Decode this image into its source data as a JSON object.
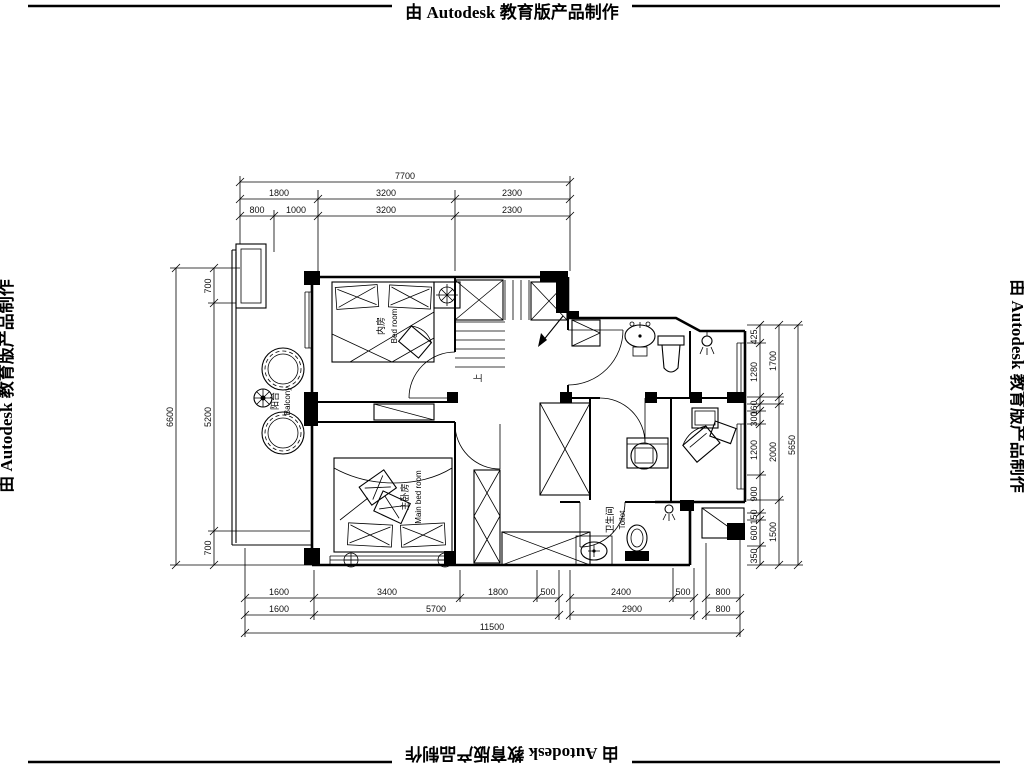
{
  "stamp": {
    "text": "由 Autodesk 教育版产品制作"
  },
  "rooms": {
    "bedroom": {
      "zh": "内房",
      "en": "Bed room"
    },
    "main_bedroom": {
      "zh": "主卧房",
      "en": "Main bed room"
    },
    "balcony": {
      "zh": "阳台",
      "en": "Balcony"
    },
    "toilet": {
      "zh": "卫生间",
      "en": "Toilet"
    },
    "stair_up": "上"
  },
  "dims": {
    "top": {
      "overall": "7700",
      "row2": [
        "1800",
        "3200",
        "2300"
      ],
      "row3": [
        "800",
        "1000",
        "3200",
        "2300"
      ]
    },
    "left": {
      "overall": "6600",
      "chain": [
        "700",
        "5200",
        "700"
      ]
    },
    "right": {
      "overall": "5650",
      "mid": [
        "1700",
        "2000",
        "1500"
      ],
      "chain": [
        "425",
        "1280",
        "160",
        "300",
        "1200",
        "900",
        "150",
        "600",
        "350"
      ]
    },
    "bottom": {
      "row1": [
        "1600",
        "3400",
        "1800",
        "500",
        "2400",
        "500",
        "800"
      ],
      "row2": [
        "1600",
        "5700",
        "2900",
        "800"
      ],
      "overall": "11500"
    }
  },
  "colors": {
    "line": "#000000",
    "background": "#ffffff"
  }
}
